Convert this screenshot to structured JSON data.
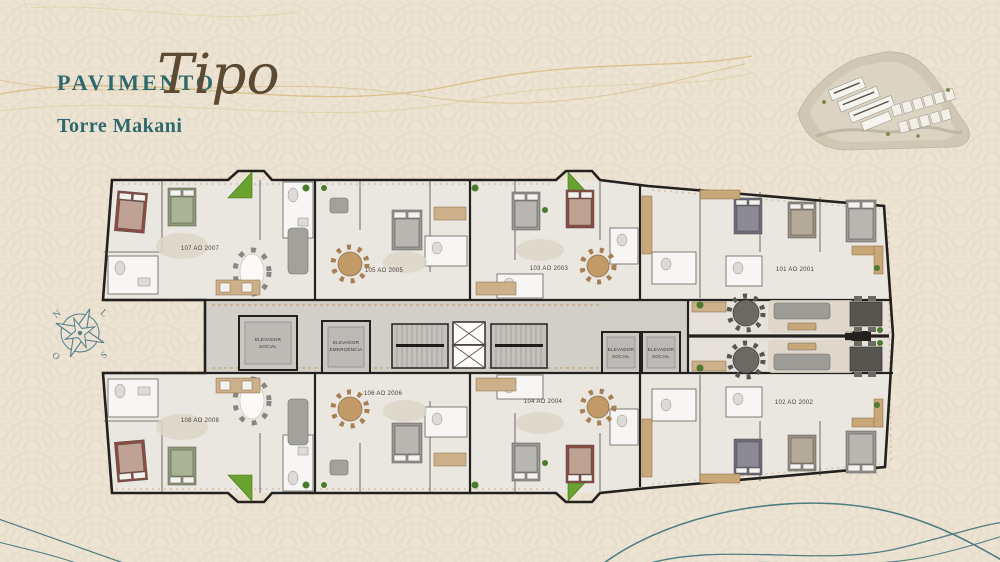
{
  "header": {
    "title_prefix": "PAVIMENTO",
    "title_script": "Tipo",
    "subtitle": "Torre Makani"
  },
  "compass": {
    "north": "N",
    "east": "L",
    "south": "S",
    "west": "O"
  },
  "floorplan": {
    "units": [
      {
        "id": "107",
        "label": "107 AO 2007"
      },
      {
        "id": "105",
        "label": "105 AO 2005"
      },
      {
        "id": "103",
        "label": "103 AO 2003"
      },
      {
        "id": "101",
        "label": "101 AO 2001"
      },
      {
        "id": "108",
        "label": "108 AO 2008"
      },
      {
        "id": "106",
        "label": "106 AO 2006"
      },
      {
        "id": "104",
        "label": "104 AO 2004"
      },
      {
        "id": "102",
        "label": "102 AO 2002"
      }
    ],
    "elevators": [
      {
        "line1": "ELEVADOR",
        "line2": "SOCIAL"
      },
      {
        "line1": "ELEVADOR",
        "line2": "EMERGÊNCIA"
      },
      {
        "line1": "ELEVADOR",
        "line2": "SOCIAL"
      },
      {
        "line1": "ELEVADOR",
        "line2": "SOCIAL"
      }
    ]
  },
  "colors": {
    "background": "#ece3d3",
    "accent_teal": "#2e686d",
    "script_brown": "#5d4a33",
    "wave_gold": "#d9bc85",
    "wave_teal": "#4e7d80",
    "wall_dark": "#23211e",
    "balcony_green": "#69a22f"
  }
}
